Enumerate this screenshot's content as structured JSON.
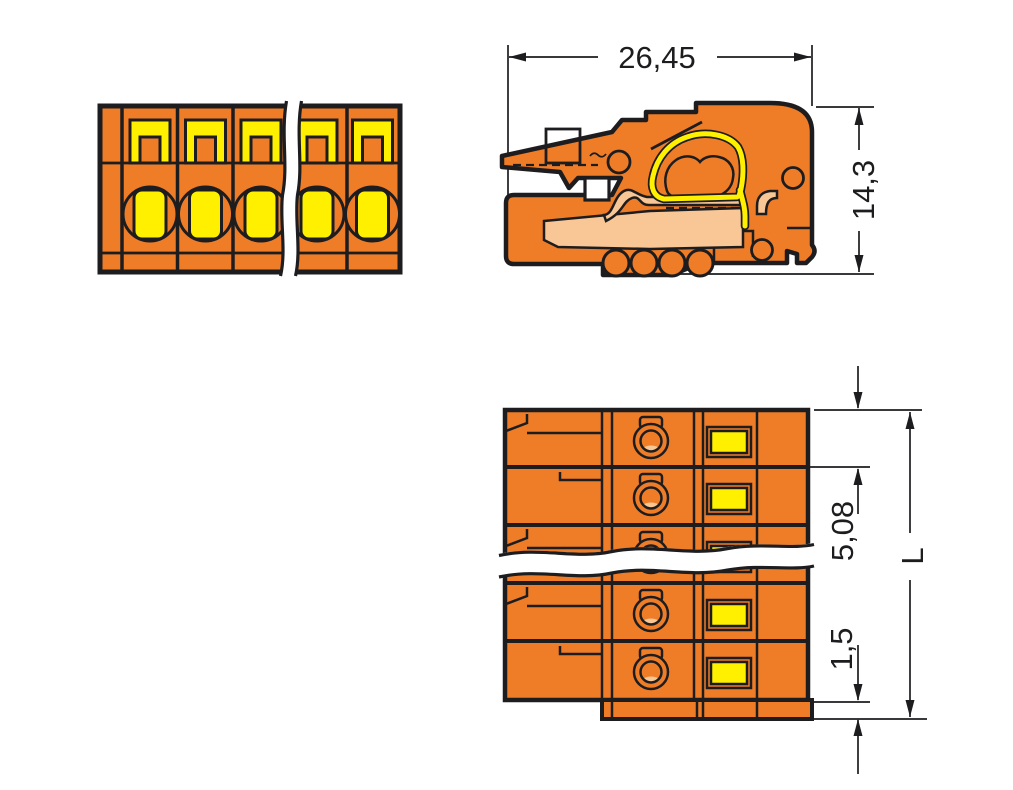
{
  "dimensions": {
    "total_width": "26,45",
    "height": "14,3",
    "pole_pitch": "5,08",
    "edge_offset": "1,5",
    "length": "L"
  },
  "views": {
    "front": {
      "poles_shown": 5,
      "break_symbol": true
    },
    "side_section": {
      "wire_entry_ports": 4
    },
    "rear": {
      "rows_shown": 5,
      "break_symbol": true
    }
  },
  "colors": {
    "housing_orange": "#EF7D28",
    "marking_yellow": "#FFF000",
    "contact_tan": "#F8C795",
    "line_ink": "#1D1D20",
    "background": "#FFFFFF"
  }
}
